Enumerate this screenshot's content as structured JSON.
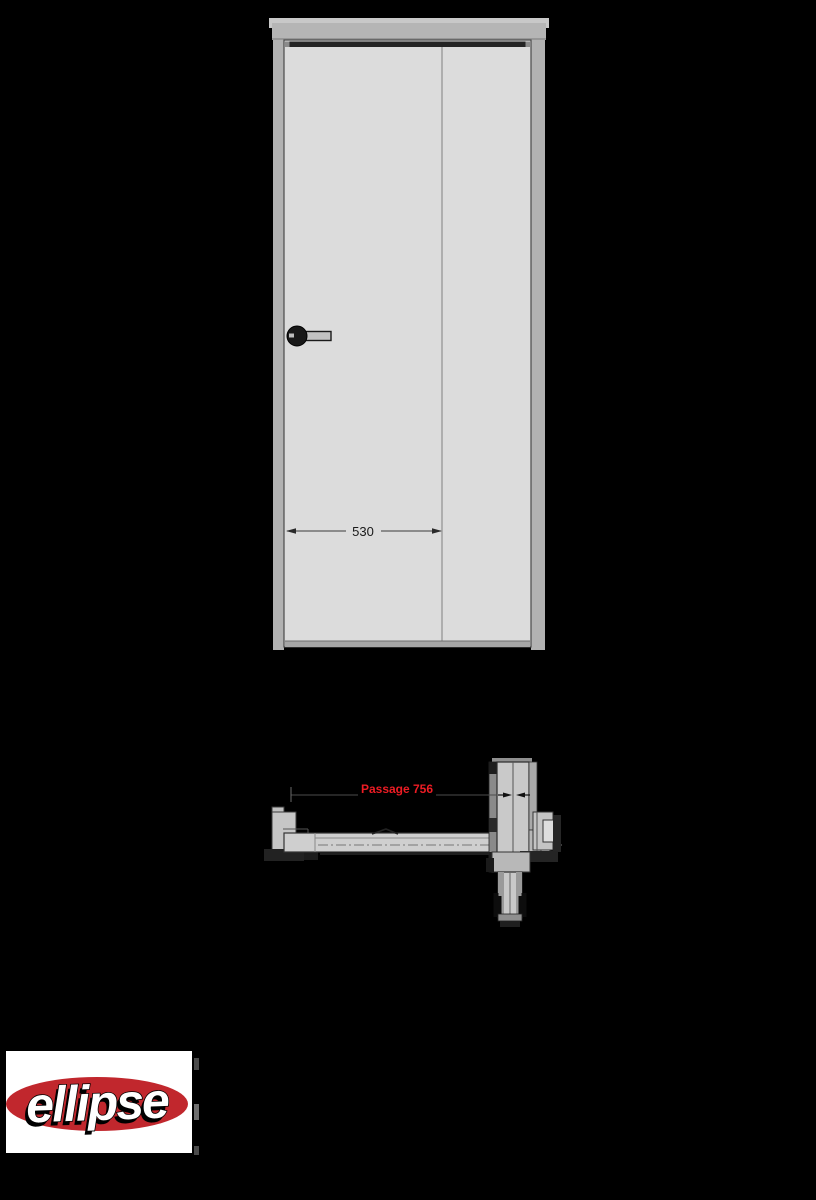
{
  "views": {
    "elevation": {
      "name": "door elevation",
      "leaf_width_label": "530"
    },
    "plan": {
      "name": "door plan section (open position)",
      "passage_label": "Passage 756"
    }
  },
  "logo": {
    "text": "ellipse"
  },
  "colors": {
    "background": "#000000",
    "frame_gray": "#b2b2b2",
    "header_gray": "#b5b5b5",
    "header_light": "#c8c8c8",
    "leaf_gray": "#dcdcdc",
    "panel_gray": "#cfcfcf",
    "dark_seal": "#242424",
    "outline": "#3a3a3a",
    "dimension_ink": "#1a1a1a",
    "passage_red": "#ed1c24",
    "logo_red": "#c1272d",
    "logo_box": "#ffffff"
  }
}
